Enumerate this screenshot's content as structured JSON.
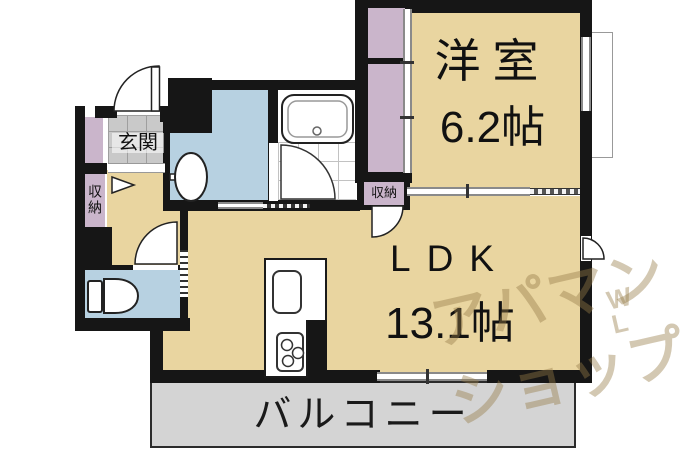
{
  "title": "apartment-floor-plan",
  "rooms": {
    "western_room": {
      "name": "洋室",
      "size": "6.2帖"
    },
    "ldk": {
      "name": "LDK",
      "size": "13.1帖"
    },
    "balcony": {
      "name": "バルコニー"
    },
    "entrance": {
      "name": "玄関"
    },
    "storage_hall": {
      "name": "収納"
    },
    "storage_west": {
      "name": "収納"
    }
  },
  "watermark": {
    "line1": "アパマン",
    "line2": "ショップ",
    "badge_top": "W",
    "badge_bottom": "L"
  },
  "colors": {
    "room_floor": "#e9d5a0",
    "closet": "#cab5cb",
    "wet_area": "#b7d1e1",
    "entrance_tile": "#c9c9c9",
    "balcony": "#d4d4d4",
    "wall": "#161616"
  }
}
